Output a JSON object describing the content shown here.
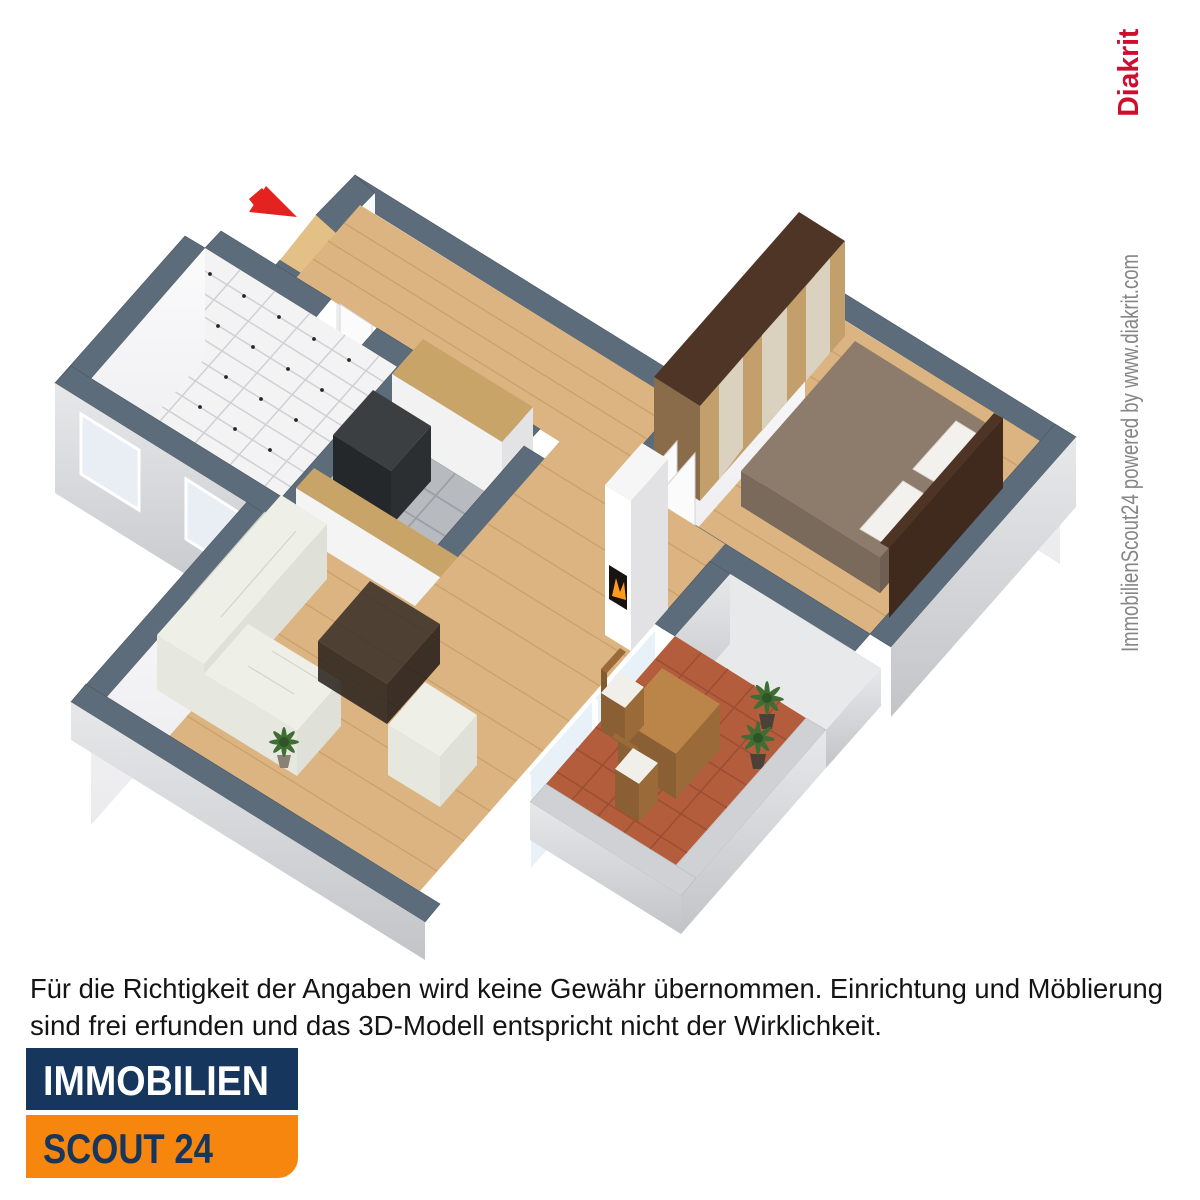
{
  "page": {
    "background": "#ffffff"
  },
  "floor_plan": {
    "type": "3d-floor-plan-isometric",
    "entrance_arrow_color": "#e42320",
    "wall_top_color": "#5c6c7b",
    "wall_face_color": "#f7f8f9",
    "exterior_face_color": "#c9cbce",
    "rooms": [
      {
        "name": "hallway",
        "floor": "light wood parquet",
        "features": [
          "entrance door opening",
          "wooden coat rack on wall"
        ]
      },
      {
        "name": "bathroom",
        "floor": "white tiles with black dot accents",
        "features": [
          "window in outer wall",
          "door from hallway"
        ]
      },
      {
        "name": "kitchen",
        "floor": "gray tiles",
        "features": [
          "wooden counter at wall",
          "dark stove unit",
          "long wooden bar counter",
          "window in outer wall"
        ]
      },
      {
        "name": "living-room",
        "floor": "wood parquet",
        "features": [
          "white corner sofa",
          "smoked glass coffee table",
          "white armchair",
          "corner fireplace with fire",
          "potted plant",
          "glass door to balcony"
        ]
      },
      {
        "name": "bedroom",
        "floor": "wood parquet",
        "features": [
          "double bed with brown duvet and white pillows",
          "wardrobe with mirrored doors",
          "window with white sill"
        ]
      },
      {
        "name": "balcony",
        "floor": "terracotta tiles",
        "features": [
          "wooden dining table",
          "two wooden chairs with white cushions",
          "two potted plants",
          "gray parapet walls"
        ]
      }
    ],
    "colors": {
      "wood_floor": "#dcb482",
      "tile_white": "#f3f3f4",
      "tile_gray": "#b7bbc0",
      "terracotta": "#b35d3d",
      "sofa": "#eef0e8",
      "bed_duvet": "#8d7b6b",
      "wardrobe_front": "#c3a06b",
      "fire": "#ff9a1f"
    }
  },
  "watermark": {
    "powered_text": "ImmobilienScout24 powered by www.diakrit.com",
    "brand": "Diakrit",
    "brand_color": "#cf0d2e",
    "text_color": "#868686"
  },
  "disclaimer": {
    "line1": "Für die Richtigkeit der Angaben wird keine Gewähr übernommen. Einrichtung und Möblierung",
    "line2": "sind frei erfunden und das 3D-Modell entspricht nicht der Wirklichkeit.",
    "color": "#141414"
  },
  "logo": {
    "top_label": "IMMOBILIEN",
    "bottom_label": "SCOUT 24",
    "top_bg": "#16365d",
    "bottom_bg": "#f6860d",
    "top_text_color": "#ffffff",
    "bottom_text_color": "#16365d"
  }
}
